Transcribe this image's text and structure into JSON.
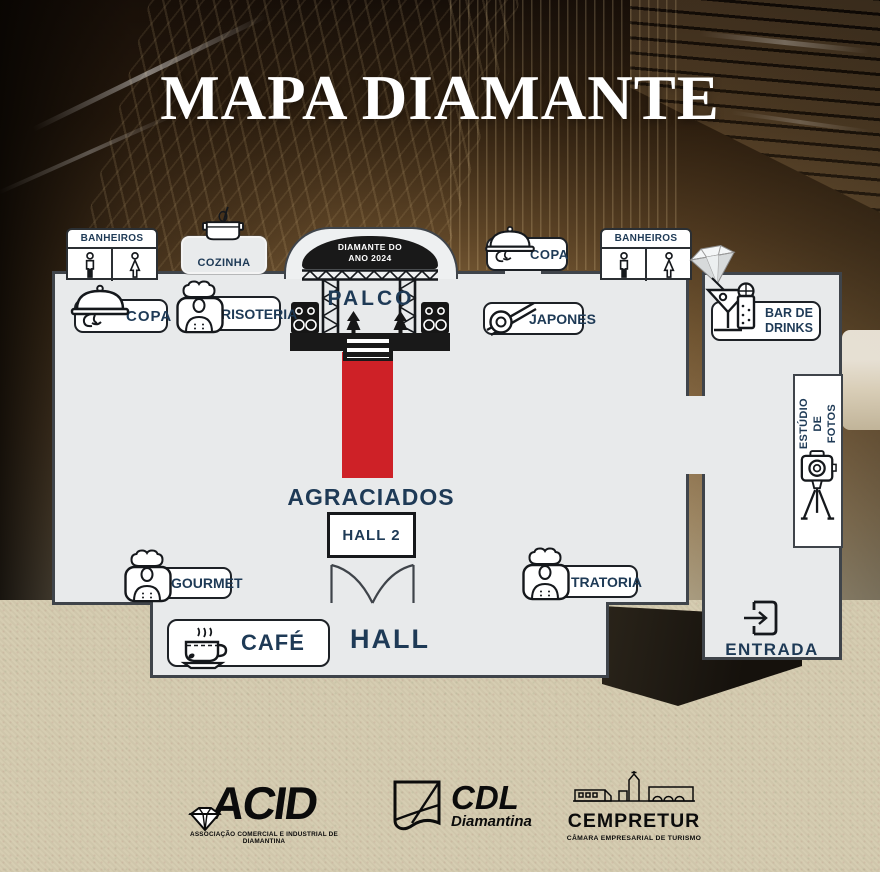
{
  "title": "MAPA DIAMANTE",
  "stage": {
    "banner": "DIAMANTE DO\nANO 2024",
    "palco": "PALCO"
  },
  "rooms": {
    "agraciados": "AGRACIADOS",
    "hall2": "HALL 2",
    "hall": "HALL"
  },
  "pois": {
    "banheiros_left": "BANHEIROS",
    "banheiros_right": "BANHEIROS",
    "cozinha": "COZINHA",
    "copa_left": "COPA",
    "copa_right": "COPA",
    "risoteria": "RISOTERIA",
    "japones": "JAPONES",
    "bar_de_drinks": "BAR DE\nDRINKS",
    "gourmet": "GOURMET",
    "tratoria": "TRATORIA",
    "cafe": "CAFÉ",
    "estudio_de_fotos": "ESTÚDIO\nDE FOTOS",
    "entrada": "ENTRADA"
  },
  "logos": {
    "acid": {
      "name": "ACID",
      "tagline": "ASSOCIAÇÃO COMERCIAL E INDUSTRIAL DE DIAMANTINA"
    },
    "cdl": {
      "name": "CDL",
      "subtitle": "Diamantina"
    },
    "cempretur": {
      "name": "CEMPRETUR",
      "tagline": "CÂMARA EMPRESARIAL DE TURISMO"
    }
  },
  "icons": {
    "banheiros": "male-and-female-restroom-figures",
    "cozinha": "cooking-pot-with-whisk",
    "copa": "hand-holding-cloche",
    "risoteria": "chef-bust",
    "japones": "sushi-roll-with-chopsticks",
    "bar_de_drinks": "martini-and-highball-glass",
    "gourmet": "chef-bust",
    "tratoria": "chef-bust",
    "cafe": "coffee-cup-with-steam",
    "estudio_de_fotos": "camera-on-tripod",
    "entrada": "arrow-entering-door",
    "stage_scenery": "truss-speakers-stairs-red-carpet",
    "corner_gem": "diamond-gem"
  },
  "colors": {
    "navy": "#1e3a56",
    "carpet_red": "#ce2127",
    "wall": "#3f444a",
    "room_fill": "#e8eaeb",
    "sand": "#d6cdb2",
    "stage_black": "#191919",
    "title_white": "#ffffff"
  }
}
